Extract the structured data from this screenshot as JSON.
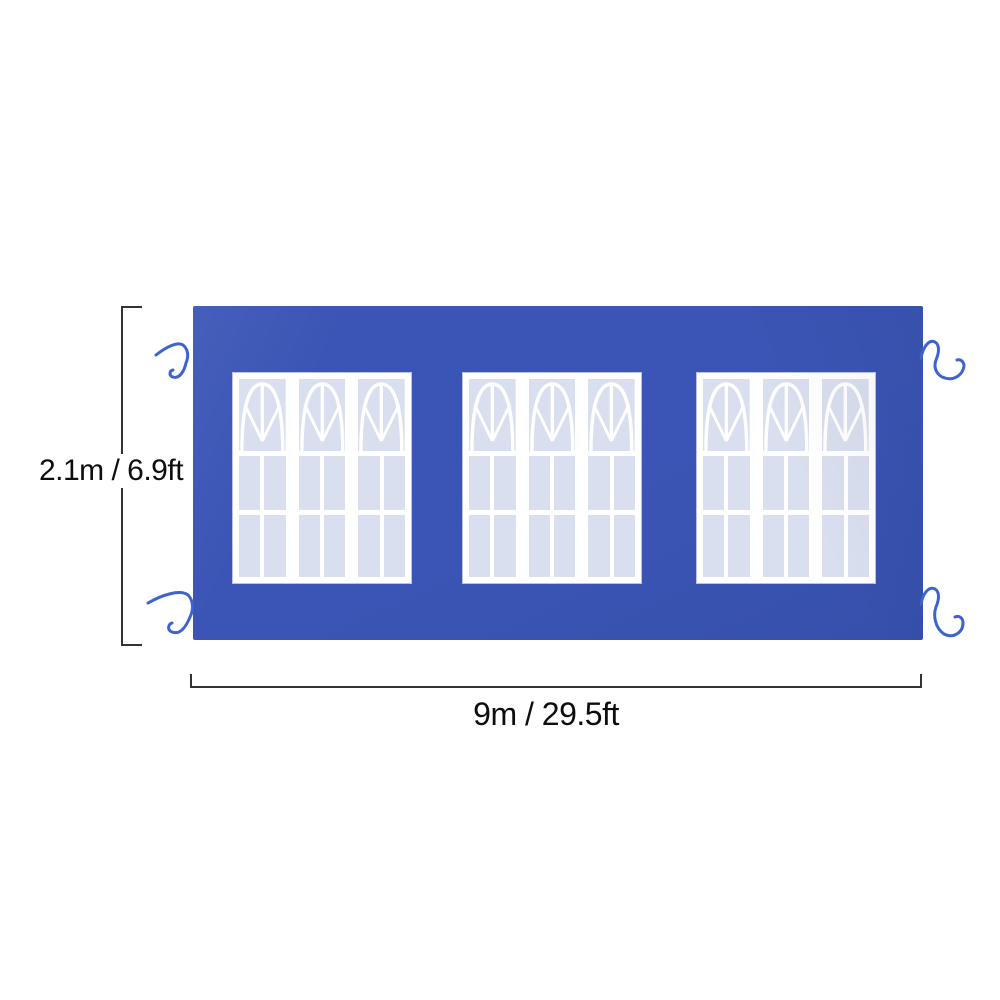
{
  "title": "canopy sidewall size diagram",
  "dimensions": {
    "height_label": "2.1m / 6.9ft",
    "width_label": "9m / 29.5ft"
  },
  "structure": {
    "window_count": 3,
    "panels_per_window": 3,
    "panes_per_panel_row": 2,
    "corner_tie_count": 4
  },
  "colors": {
    "tarp_blue": "#3a55b5",
    "tarp_blue_dark": "#3650ab",
    "pane_blue": "#d9dfef",
    "mullion_white": "#ffffff",
    "tie_blue": "#3d63cd",
    "dim_line": "#333333",
    "text": "#0d0d0d",
    "background": "#ffffff"
  }
}
